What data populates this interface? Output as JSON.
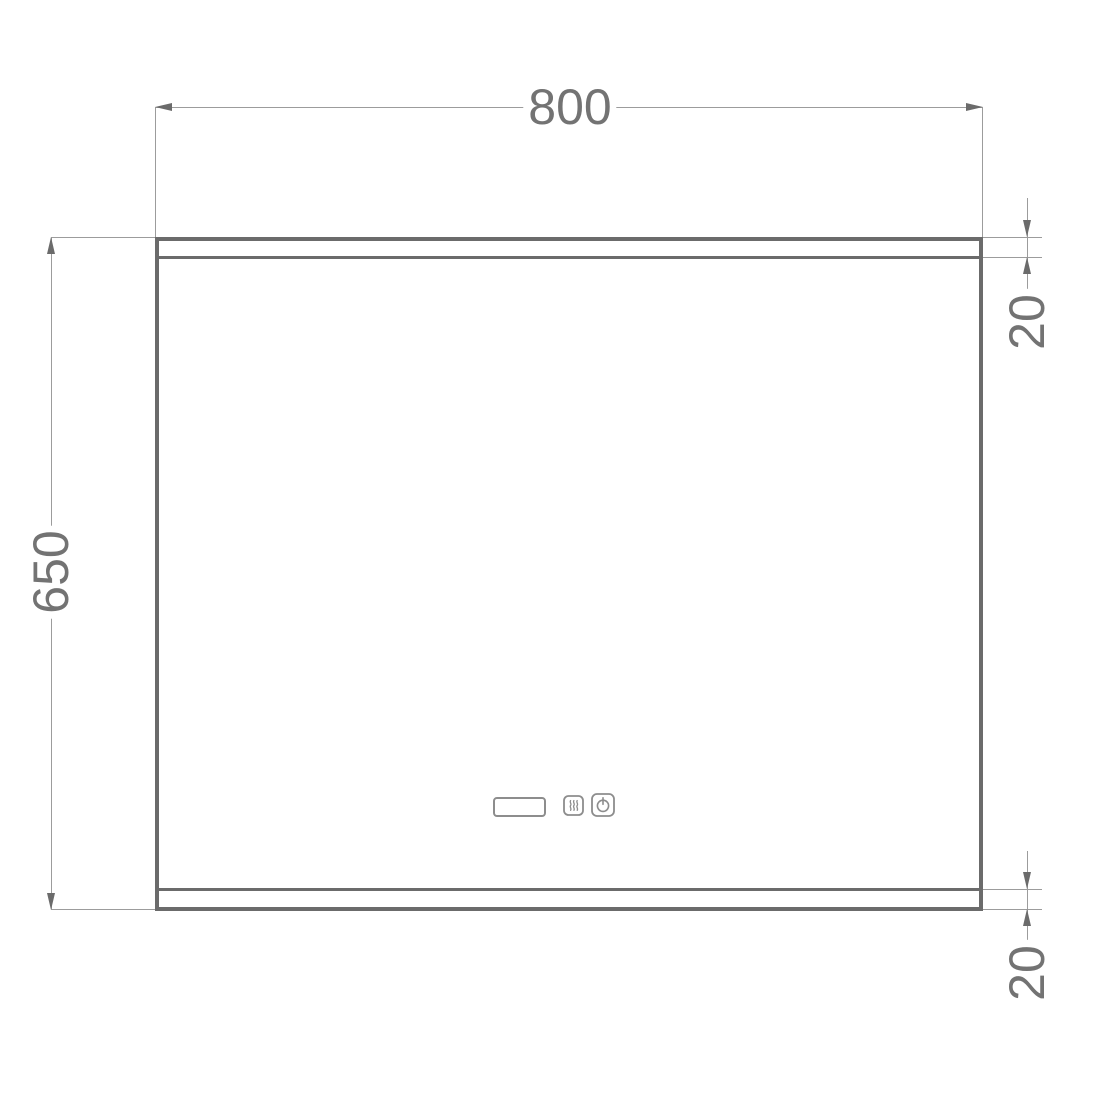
{
  "dimensions": {
    "width": "800",
    "height": "650",
    "top_strip": "20",
    "bottom_strip": "20"
  },
  "controls": {
    "display_window": "display-window",
    "defog_button": "defog-icon",
    "power_button": "power-icon"
  },
  "colors": {
    "background": "#ffffff",
    "outline": "#6b6b6b",
    "dimension_line": "#9c9c9c",
    "dimension_text": "#737373",
    "icon_stroke": "#8d8d8d"
  }
}
